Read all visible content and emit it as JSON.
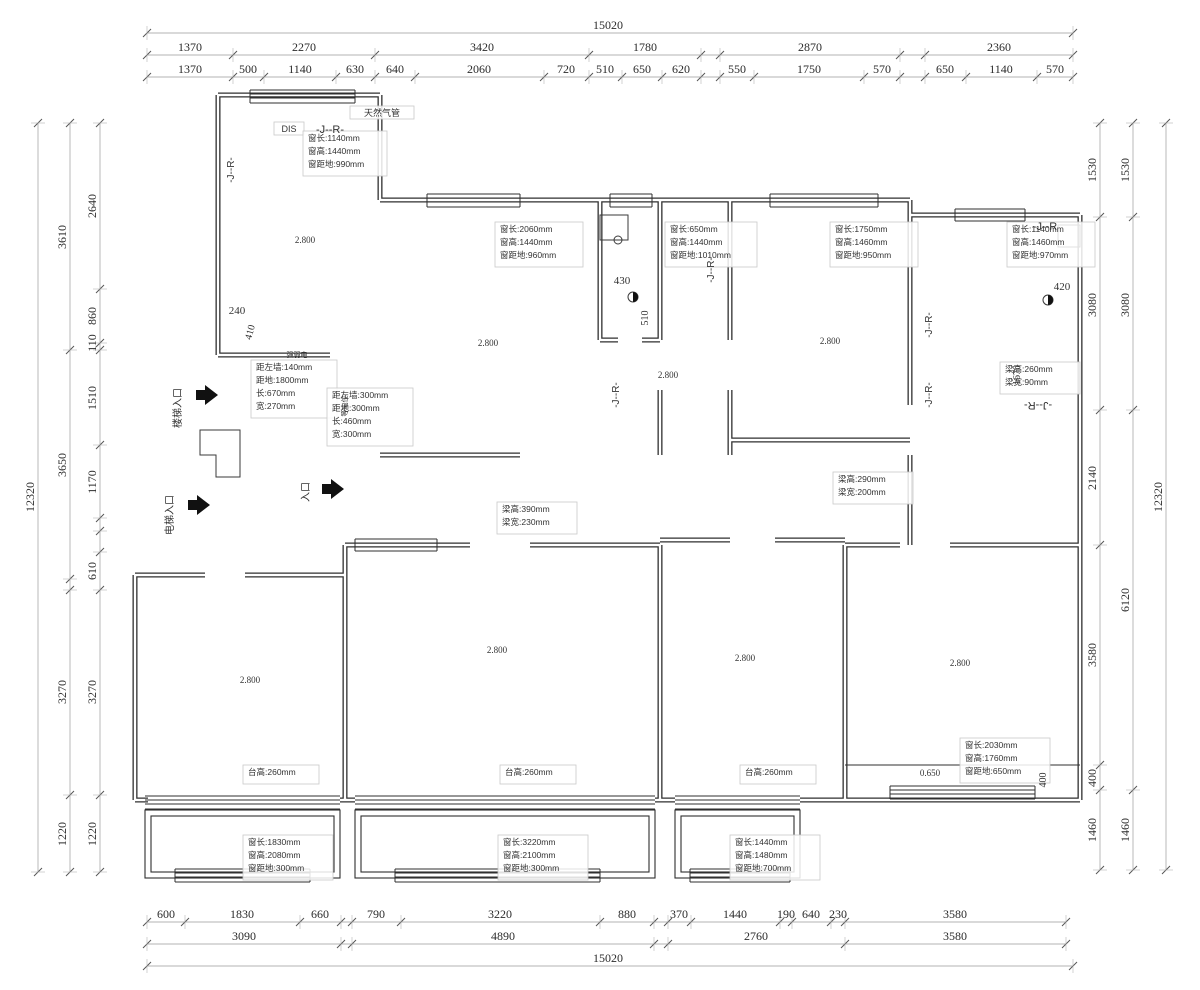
{
  "colors": {
    "wall": "#2f2f2f",
    "dim_line": "#9a9a9a",
    "text": "#333333",
    "box_border": "#c9c9c9"
  },
  "dim_rows": [
    {
      "name": "top-total",
      "axis": "h",
      "pos": 33,
      "ticks": [
        147,
        1073
      ],
      "labels": [
        {
          "t": "15020",
          "at": 608
        }
      ]
    },
    {
      "name": "top-major",
      "axis": "h",
      "pos": 55,
      "ticks": [
        147,
        233,
        375,
        589,
        701,
        720,
        900,
        925,
        1073
      ],
      "labels": [
        {
          "t": "1370",
          "at": 190
        },
        {
          "t": "2270",
          "at": 304
        },
        {
          "t": "3420",
          "at": 482
        },
        {
          "t": "1780",
          "at": 645
        },
        {
          "t": "2870",
          "at": 810
        },
        {
          "t": "2360",
          "at": 999
        }
      ]
    },
    {
      "name": "top-minor",
      "axis": "h",
      "pos": 77,
      "ticks": [
        147,
        233,
        264,
        336,
        375,
        415,
        544,
        589,
        622,
        662,
        701,
        720,
        754,
        864,
        900,
        925,
        966,
        1037,
        1073
      ],
      "labels": [
        {
          "t": "1370",
          "at": 190
        },
        {
          "t": "500",
          "at": 248
        },
        {
          "t": "1140",
          "at": 300
        },
        {
          "t": "630",
          "at": 355
        },
        {
          "t": "640",
          "at": 395
        },
        {
          "t": "2060",
          "at": 479
        },
        {
          "t": "720",
          "at": 566
        },
        {
          "t": "510",
          "at": 605
        },
        {
          "t": "650",
          "at": 642
        },
        {
          "t": "620",
          "at": 681
        },
        {
          "t": "550",
          "at": 737
        },
        {
          "t": "1750",
          "at": 809
        },
        {
          "t": "570",
          "at": 882
        },
        {
          "t": "650",
          "at": 945
        },
        {
          "t": "1140",
          "at": 1001
        },
        {
          "t": "570",
          "at": 1055
        }
      ]
    },
    {
      "name": "bottom-minor",
      "axis": "h",
      "pos": 922,
      "ticks": [
        147,
        185,
        300,
        341,
        352,
        401,
        600,
        654,
        668,
        691,
        780,
        792,
        831,
        845,
        1066
      ],
      "labels": [
        {
          "t": "600",
          "at": 166
        },
        {
          "t": "1830",
          "at": 242
        },
        {
          "t": "660",
          "at": 320
        },
        {
          "t": "790",
          "at": 376
        },
        {
          "t": "3220",
          "at": 500
        },
        {
          "t": "880",
          "at": 627
        },
        {
          "t": "370",
          "at": 679
        },
        {
          "t": "1440",
          "at": 735
        },
        {
          "t": "190",
          "at": 786
        },
        {
          "t": "640",
          "at": 811
        },
        {
          "t": "230",
          "at": 838
        },
        {
          "t": "3580",
          "at": 955
        }
      ]
    },
    {
      "name": "bottom-major",
      "axis": "h",
      "pos": 944,
      "ticks": [
        147,
        341,
        352,
        654,
        668,
        845,
        1066
      ],
      "labels": [
        {
          "t": "3090",
          "at": 244
        },
        {
          "t": "4890",
          "at": 503
        },
        {
          "t": "2760",
          "at": 756
        },
        {
          "t": "3580",
          "at": 955
        }
      ]
    },
    {
      "name": "bottom-total",
      "axis": "h",
      "pos": 966,
      "ticks": [
        147,
        1073
      ],
      "labels": [
        {
          "t": "15020",
          "at": 608
        }
      ]
    },
    {
      "name": "left-minor",
      "axis": "v",
      "pos": 100,
      "ticks": [
        123,
        289,
        343,
        350,
        445,
        518,
        531,
        552,
        590,
        795,
        872
      ],
      "labels": [
        {
          "t": "2640",
          "at": 206
        },
        {
          "t": "860",
          "at": 316
        },
        {
          "t": "110",
          "at": 343
        },
        {
          "t": "1510",
          "at": 398
        },
        {
          "t": "1170",
          "at": 482
        },
        {
          "t": "610",
          "at": 571
        },
        {
          "t": "3270",
          "at": 692
        },
        {
          "t": "1220",
          "at": 834
        }
      ]
    },
    {
      "name": "left-major",
      "axis": "v",
      "pos": 70,
      "ticks": [
        123,
        350,
        579,
        590,
        795,
        872
      ],
      "labels": [
        {
          "t": "3610",
          "at": 237
        },
        {
          "t": "3650",
          "at": 465
        },
        {
          "t": "3270",
          "at": 692
        },
        {
          "t": "1220",
          "at": 834
        }
      ]
    },
    {
      "name": "left-total",
      "axis": "v",
      "pos": 38,
      "ticks": [
        123,
        872
      ],
      "labels": [
        {
          "t": "12320",
          "at": 497
        }
      ]
    },
    {
      "name": "right-minor",
      "axis": "v",
      "pos": 1100,
      "ticks": [
        123,
        217,
        410,
        545,
        765,
        790,
        870
      ],
      "labels": [
        {
          "t": "1530",
          "at": 170
        },
        {
          "t": "3080",
          "at": 305
        },
        {
          "t": "2140",
          "at": 478
        },
        {
          "t": "3580",
          "at": 655
        },
        {
          "t": "400",
          "at": 778
        },
        {
          "t": "1460",
          "at": 830
        }
      ]
    },
    {
      "name": "right-major",
      "axis": "v",
      "pos": 1133,
      "ticks": [
        123,
        217,
        410,
        790,
        870
      ],
      "labels": [
        {
          "t": "1530",
          "at": 170
        },
        {
          "t": "3080",
          "at": 305
        },
        {
          "t": "6120",
          "at": 600
        },
        {
          "t": "1460",
          "at": 830
        }
      ]
    },
    {
      "name": "right-total",
      "axis": "v",
      "pos": 1166,
      "ticks": [
        123,
        870
      ],
      "labels": [
        {
          "t": "12320",
          "at": 497
        }
      ]
    }
  ],
  "spec_blocks": [
    {
      "x": 308,
      "y": 141,
      "w": 74,
      "lines": [
        "窗长:1140mm",
        "窗高:1440mm",
        "窗距地:990mm"
      ]
    },
    {
      "x": 500,
      "y": 232,
      "w": 78,
      "lines": [
        "窗长:2060mm",
        "窗高:1440mm",
        "窗距地:960mm"
      ]
    },
    {
      "x": 670,
      "y": 232,
      "w": 82,
      "lines": [
        "窗长:650mm",
        "窗高:1440mm",
        "窗距地:1010mm"
      ]
    },
    {
      "x": 835,
      "y": 232,
      "w": 78,
      "lines": [
        "窗长:1750mm",
        "窗高:1460mm",
        "窗距地:950mm"
      ]
    },
    {
      "x": 1012,
      "y": 232,
      "w": 78,
      "lines": [
        "窗长:1140mm",
        "窗高:1460mm",
        "窗距地:970mm"
      ]
    },
    {
      "x": 1005,
      "y": 372,
      "w": 70,
      "lines": [
        "梁高:260mm",
        "梁宽:90mm"
      ]
    },
    {
      "x": 838,
      "y": 482,
      "w": 70,
      "lines": [
        "梁高:290mm",
        "梁宽:200mm"
      ]
    },
    {
      "x": 502,
      "y": 512,
      "w": 70,
      "lines": [
        "梁高:390mm",
        "梁宽:230mm"
      ]
    },
    {
      "x": 256,
      "y": 370,
      "w": 76,
      "lines": [
        "距左墙:140mm",
        "距地:1800mm",
        "长:670mm",
        "宽:270mm"
      ]
    },
    {
      "x": 332,
      "y": 398,
      "w": 76,
      "lines": [
        "距左墙:300mm",
        "距地:300mm",
        "长:460mm",
        "宽:300mm"
      ]
    },
    {
      "x": 248,
      "y": 845,
      "w": 80,
      "lines": [
        "窗长:1830mm",
        "窗高:2080mm",
        "窗距地:300mm"
      ]
    },
    {
      "x": 503,
      "y": 845,
      "w": 80,
      "lines": [
        "窗长:3220mm",
        "窗高:2100mm",
        "窗距地:300mm"
      ]
    },
    {
      "x": 735,
      "y": 845,
      "w": 80,
      "lines": [
        "窗长:1440mm",
        "窗高:1480mm",
        "窗距地:700mm"
      ]
    },
    {
      "x": 965,
      "y": 748,
      "w": 80,
      "lines": [
        "窗长:2030mm",
        "窗高:1760mm",
        "窗距地:650mm"
      ]
    },
    {
      "x": 248,
      "y": 775,
      "w": 66,
      "lines": [
        "台高:260mm"
      ]
    },
    {
      "x": 505,
      "y": 775,
      "w": 66,
      "lines": [
        "台高:260mm"
      ]
    },
    {
      "x": 745,
      "y": 775,
      "w": 66,
      "lines": [
        "台高:260mm"
      ]
    }
  ],
  "free_texts": [
    {
      "t": "天然气管",
      "x": 382,
      "y": 116,
      "s": 9,
      "f": "sans"
    },
    {
      "t": "DIS",
      "x": 289,
      "y": 132,
      "s": 9,
      "f": "sans"
    },
    {
      "t": "-J--R-",
      "x": 330,
      "y": 133,
      "s": 11,
      "f": "sans"
    },
    {
      "t": "-J--R-",
      "x": 234,
      "y": 170,
      "s": 10,
      "f": "sans",
      "r": -90
    },
    {
      "t": "-J--R-",
      "x": 714,
      "y": 270,
      "s": 10,
      "f": "sans",
      "r": -90
    },
    {
      "t": "-J--R-",
      "x": 619,
      "y": 395,
      "s": 10,
      "f": "sans",
      "r": -90
    },
    {
      "t": "-J--R-",
      "x": 932,
      "y": 325,
      "s": 10,
      "f": "sans",
      "r": -90
    },
    {
      "t": "-J--R-",
      "x": 932,
      "y": 395,
      "s": 10,
      "f": "sans",
      "r": -90
    },
    {
      "t": "-J--R",
      "x": 1045,
      "y": 230,
      "s": 11,
      "f": "sans"
    },
    {
      "t": "-J--R-",
      "x": 1038,
      "y": 402,
      "s": 11,
      "f": "sans",
      "r": 180
    },
    {
      "t": "2.800",
      "x": 305,
      "y": 243,
      "s": 9,
      "f": "serif"
    },
    {
      "t": "2.800",
      "x": 488,
      "y": 346,
      "s": 9,
      "f": "serif"
    },
    {
      "t": "2.800",
      "x": 668,
      "y": 378,
      "s": 9,
      "f": "serif"
    },
    {
      "t": "2.800",
      "x": 830,
      "y": 344,
      "s": 9,
      "f": "serif"
    },
    {
      "t": "2.800",
      "x": 250,
      "y": 683,
      "s": 9,
      "f": "serif"
    },
    {
      "t": "2.800",
      "x": 497,
      "y": 653,
      "s": 9,
      "f": "serif"
    },
    {
      "t": "2.800",
      "x": 745,
      "y": 661,
      "s": 9,
      "f": "serif"
    },
    {
      "t": "2.800",
      "x": 960,
      "y": 666,
      "s": 9,
      "f": "serif"
    },
    {
      "t": "0.650",
      "x": 930,
      "y": 776,
      "s": 9,
      "f": "serif"
    },
    {
      "t": "430",
      "x": 622,
      "y": 284,
      "s": 11,
      "f": "serif"
    },
    {
      "t": "510",
      "x": 648,
      "y": 318,
      "s": 10,
      "f": "serif",
      "r": -90
    },
    {
      "t": "240",
      "x": 237,
      "y": 314,
      "s": 11,
      "f": "serif"
    },
    {
      "t": "410",
      "x": 253,
      "y": 333,
      "s": 10,
      "f": "serif",
      "r": -75
    },
    {
      "t": "420",
      "x": 1062,
      "y": 290,
      "s": 11,
      "f": "serif"
    },
    {
      "t": "1670",
      "x": 1020,
      "y": 375,
      "s": 10,
      "f": "serif",
      "r": -90
    },
    {
      "t": "400",
      "x": 1046,
      "y": 780,
      "s": 10,
      "f": "serif",
      "r": -90
    },
    {
      "t": "楼梯入口",
      "x": 181,
      "y": 408,
      "s": 10,
      "f": "sans",
      "r": -90
    },
    {
      "t": "电梯入口",
      "x": 173,
      "y": 515,
      "s": 10,
      "f": "sans",
      "r": -90
    },
    {
      "t": "入口",
      "x": 309,
      "y": 492,
      "s": 10,
      "f": "sans",
      "r": -90
    },
    {
      "t": "强弱电",
      "x": 297,
      "y": 357,
      "s": 7,
      "f": "sans"
    },
    {
      "t": "等电位",
      "x": 347,
      "y": 406,
      "s": 7,
      "f": "sans",
      "r": -90
    }
  ],
  "entry_arrows": [
    {
      "x": 196,
      "y": 395
    },
    {
      "x": 188,
      "y": 505
    },
    {
      "x": 322,
      "y": 489
    }
  ]
}
